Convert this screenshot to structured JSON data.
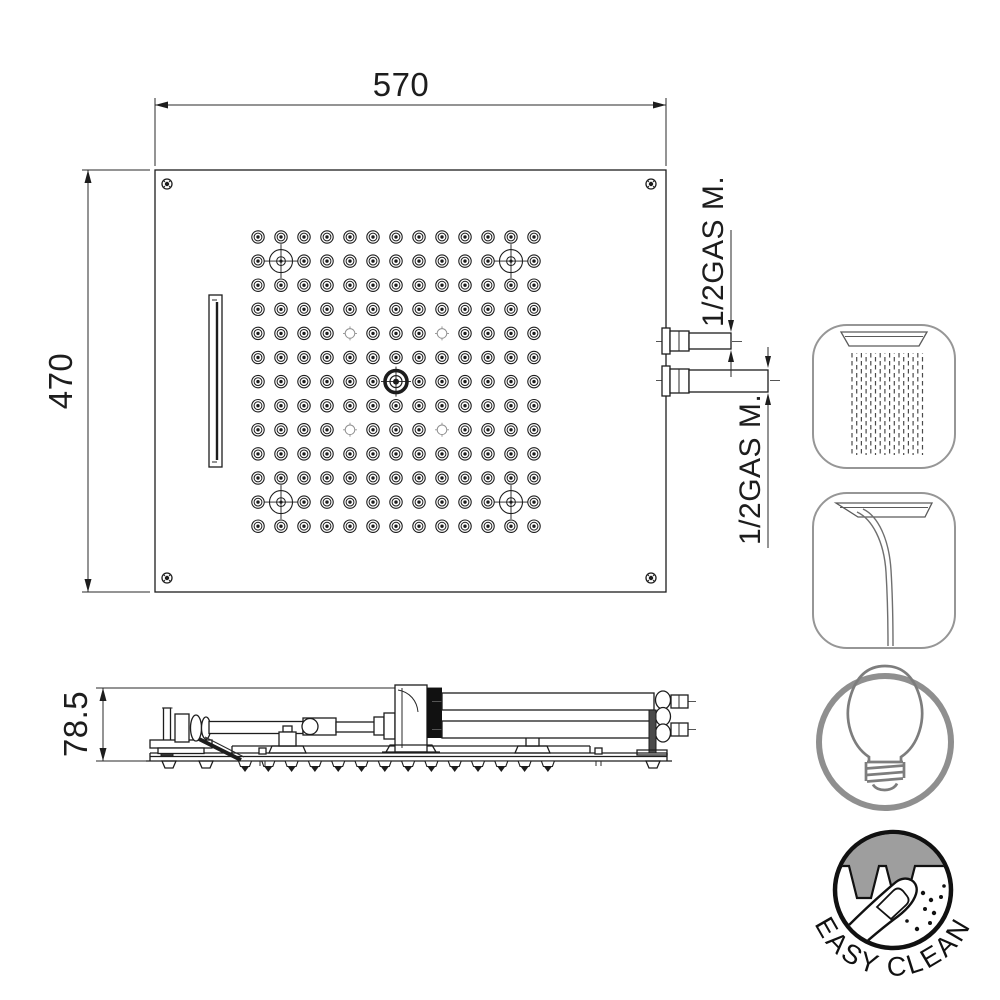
{
  "drawing": {
    "dim_width_label": "570",
    "dim_depth_label": "470",
    "dim_height_label": "78.5",
    "thread_label_top": "1/2GAS M.",
    "thread_label_bottom": "1/2GAS M."
  },
  "badge": {
    "label": "EASY CLEAN"
  },
  "icons": {
    "rain": "rain-flow-icon",
    "waterfall": "waterfall-flow-icon",
    "light": "light-icon",
    "easy_clean": "easy-clean-badge"
  },
  "colors": {
    "line": "#1d1d1d",
    "icon_gray": "#8f8f8f",
    "bulb_gray": "#7d7d7d",
    "panel_gray": "#9e9e9e",
    "badge_ink": "#111111",
    "rain_gray": "#4a4a4a"
  },
  "nozzle_grid": {
    "cols": 13,
    "rows": 13,
    "x0": 258,
    "y0": 237,
    "dx": 23,
    "dy": 24.1,
    "crosshair_cells": [
      [
        1,
        1
      ],
      [
        11,
        1
      ],
      [
        1,
        11
      ],
      [
        11,
        11
      ]
    ],
    "aerator_cells": [
      [
        4,
        4
      ],
      [
        8,
        4
      ],
      [
        4,
        8
      ],
      [
        8,
        8
      ]
    ],
    "center_cell": [
      6,
      6
    ]
  },
  "side_teeth": {
    "count": 14,
    "x0": 245,
    "dx": 23.3,
    "y": 761
  },
  "rain_lines": {
    "count": 16,
    "x0": 852,
    "dx": 4.7,
    "y0": 353,
    "y1": 455
  }
}
